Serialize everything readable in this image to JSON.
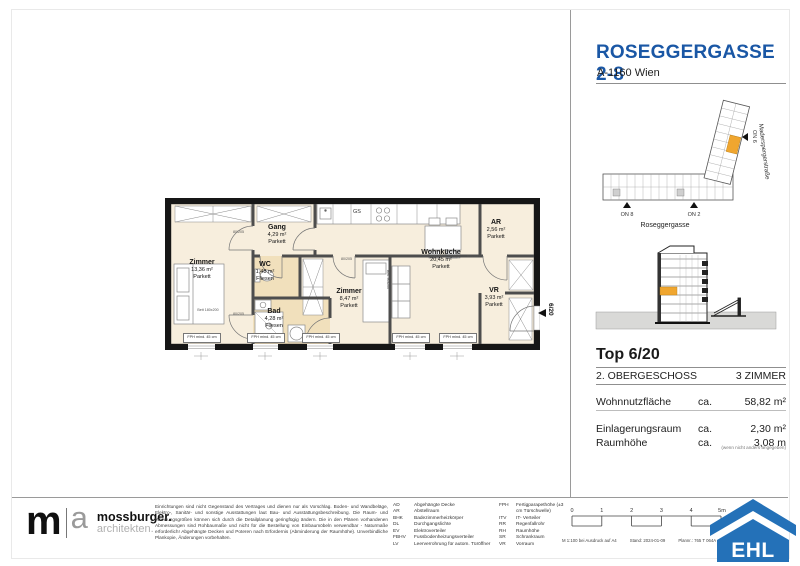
{
  "header": {
    "title": "ROSEGGERGASSE 2-8",
    "subtitle": "A-1160 Wien"
  },
  "site_plan": {
    "street_bottom": "Roseggergasse",
    "street_right": "Maderspergerstraße",
    "on8": "ON 8",
    "on2": "ON 2",
    "on6": "ON 6",
    "highlight_color": "#F0A62F"
  },
  "unit_info": {
    "top": "Top 6/20",
    "floor": "2. OBERGESCHOSS",
    "rooms": "3 ZIMMER",
    "metrics": [
      {
        "label": "Wohnnutzfläche",
        "prefix": "ca.",
        "value": "58,82 m²"
      },
      {
        "label": "Einlagerungsraum",
        "prefix": "ca.",
        "value": "2,30 m²"
      },
      {
        "label": "Raumhöhe",
        "prefix": "ca.",
        "value": "3,08 m"
      }
    ],
    "note": "(wenn nicht anders angegeben)"
  },
  "floor_plan": {
    "rooms": [
      {
        "name": "Zimmer",
        "area": "13,36 m²",
        "finish": "Parkett"
      },
      {
        "name": "Gang",
        "area": "4,29 m²",
        "finish": "Parkett"
      },
      {
        "name": "WC",
        "area": "1,48 m²",
        "finish": "Fliesen"
      },
      {
        "name": "Bad",
        "area": "4,28 m²",
        "finish": "Fliesen"
      },
      {
        "name": "Zimmer",
        "area": "8,47 m²",
        "finish": "Parkett"
      },
      {
        "name": "Wohnküche",
        "area": "20,45 m²",
        "finish": "Parkett"
      },
      {
        "name": "AR",
        "area": "2,56 m²",
        "finish": "Parkett"
      },
      {
        "name": "VR",
        "area": "3,93 m²",
        "finish": "Parkett"
      }
    ],
    "kitchen_appliance": "GS",
    "window_sill_label": "FPH mind. 45 cm",
    "bed_large": "Bett 180x200",
    "bed_small": "Bett 90x200",
    "door_size": "80/205",
    "unit_marker": "6/20"
  },
  "footer": {
    "architect": {
      "mark_m": "m",
      "mark_a": "a",
      "name": "mossburger.",
      "tagline": "architekten."
    },
    "disclaimer": "Einrichtungen sind nicht Gegenstand des Vertrages und dienen nur als Vorschlag. Boden- und Wandbeläge, Elektro-, Sanitär- und sonstige Ausstattungen laut Bau- und Ausstattungsbeschreibung. Die Raum- und Wohnungsgrößen können sich durch die Detailplanung geringfügig ändern. Die in den Plänen vorhandenen Abmessungen sind Rohbaumaße und nicht für die Bestellung von Einbaumöbeln verwendbar - Naturmaße erforderlich! Abgehängte Decken und Poteren nach Erfordernis (Abminderung der Raumhöhe). Unverbindliche Plankopie, Änderungen vorbehalten.",
    "abbreviations_left": [
      {
        "abbr": "AD",
        "label": "Abgehängte Decke"
      },
      {
        "abbr": "AR",
        "label": "Abstellraum"
      },
      {
        "abbr": "BHK",
        "label": "Badezimmerheizkörper"
      },
      {
        "abbr": "DL",
        "label": "Durchgangslichte"
      },
      {
        "abbr": "EV",
        "label": "Elektroverteiler"
      },
      {
        "abbr": "FBHV",
        "label": "Fussbodenheizungsverteiler"
      },
      {
        "abbr": "LV",
        "label": "Leerverrohrung für autom. Türöffner"
      }
    ],
    "abbreviations_right": [
      {
        "abbr": "FPH",
        "label": "Fertigparapethöhe (±3 cm Türschwelle)"
      },
      {
        "abbr": "ITV",
        "label": "IT- Verteiler"
      },
      {
        "abbr": "RR",
        "label": "Regenfallrohr"
      },
      {
        "abbr": "RH",
        "label": "Raumhöhe"
      },
      {
        "abbr": "SR",
        "label": "Schrankraum"
      },
      {
        "abbr": "VR",
        "label": "Vorraum"
      }
    ],
    "scale_ticks": [
      "0",
      "1",
      "2",
      "3",
      "4",
      "5m"
    ],
    "print_scale": "M 1:100 bei Ausdruck auf A4",
    "print_date": "Stand: 2024-01-09",
    "print_plan_no": "Plannr.: 765 T 064A",
    "brand": "EHL",
    "brand_color": "#2471B8"
  }
}
